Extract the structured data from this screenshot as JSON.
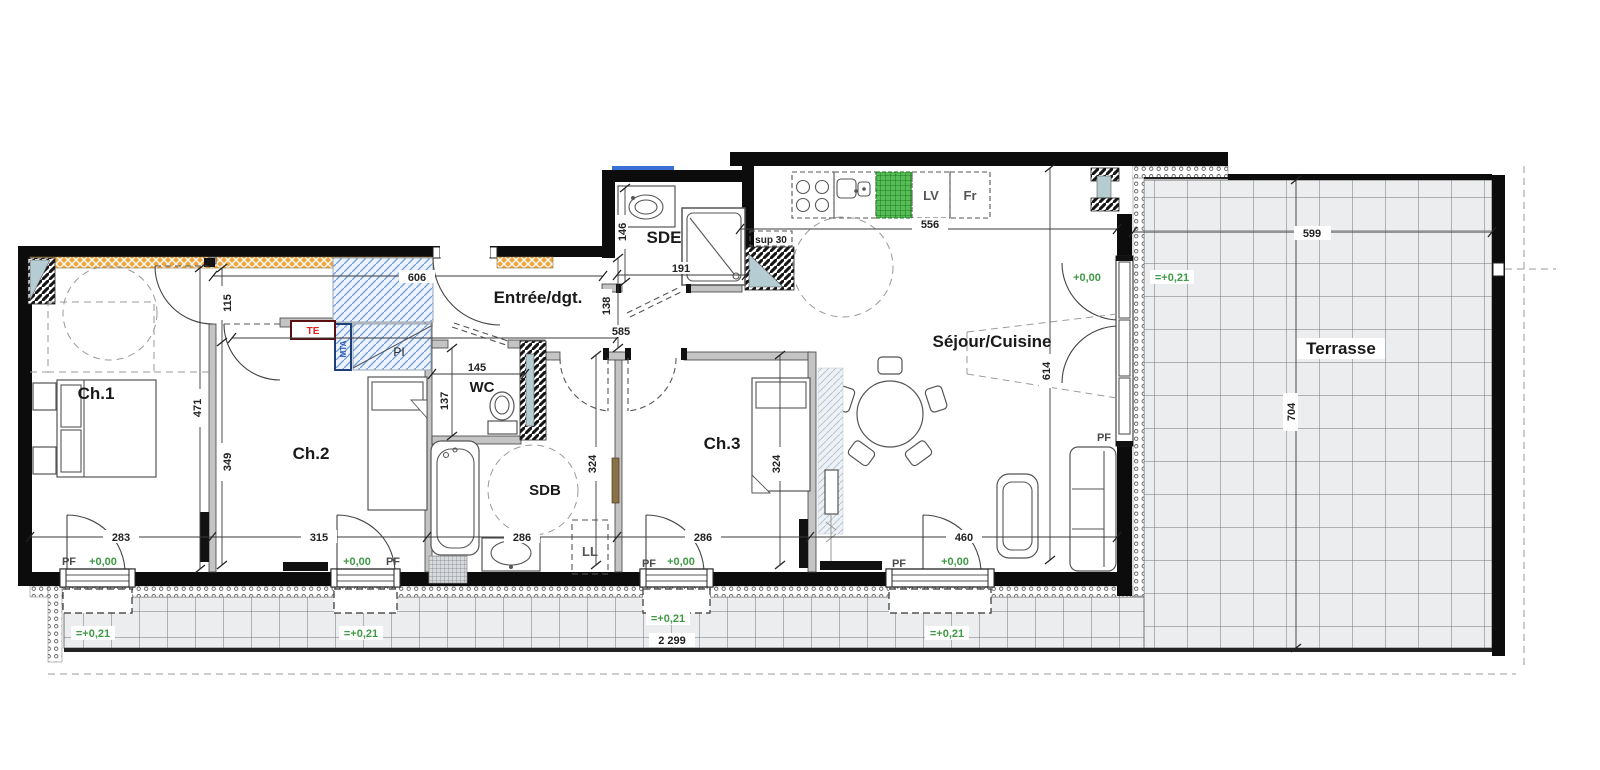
{
  "plan": {
    "rooms": {
      "ch1": "Ch.1",
      "ch2": "Ch.2",
      "ch3": "Ch.3",
      "wc": "WC",
      "sdb": "SDB",
      "sde": "SDE",
      "entree": "Entrée/dgt.",
      "sejour": "Séjour/Cuisine",
      "terrasse": "Terrasse"
    },
    "equipment": {
      "lv": "LV",
      "fr": "Fr",
      "ll": "LL",
      "te": "TE",
      "pi": "PI",
      "mta": "MTA",
      "sup": "sup 30",
      "pf": "PF",
      "section_marker": "B"
    },
    "levels": {
      "interior": "+0,00",
      "exterior": "=+0,21"
    },
    "dims": {
      "hall_length": "606",
      "hall_width": "115",
      "ch1_depth": "471",
      "ch1_inner": "349",
      "ch1_width": "283",
      "ch2_width": "315",
      "sdb_width": "286",
      "ch3_width": "286",
      "sejour_width": "460",
      "wc_depth": "137",
      "wc_width": "145",
      "sdb_depth": "324",
      "ch3_depth": "324",
      "hall_to_sdb": "585",
      "entry_depth": "138",
      "sde_width": "146",
      "sde_length": "191",
      "kitchen_length": "556",
      "sejour_depth": "614",
      "terrace_width": "599",
      "terrace_depth": "704",
      "total_width": "2 299"
    },
    "colors": {
      "insulation_orange": "#f2a53c",
      "closet_blue": "#6f9ad9",
      "appliance_green": "#57bd57",
      "level_green": "#3f9945",
      "tile_gray": "#ecedee",
      "wall_black": "#0c0c0c",
      "marker_red": "#e02020"
    }
  }
}
